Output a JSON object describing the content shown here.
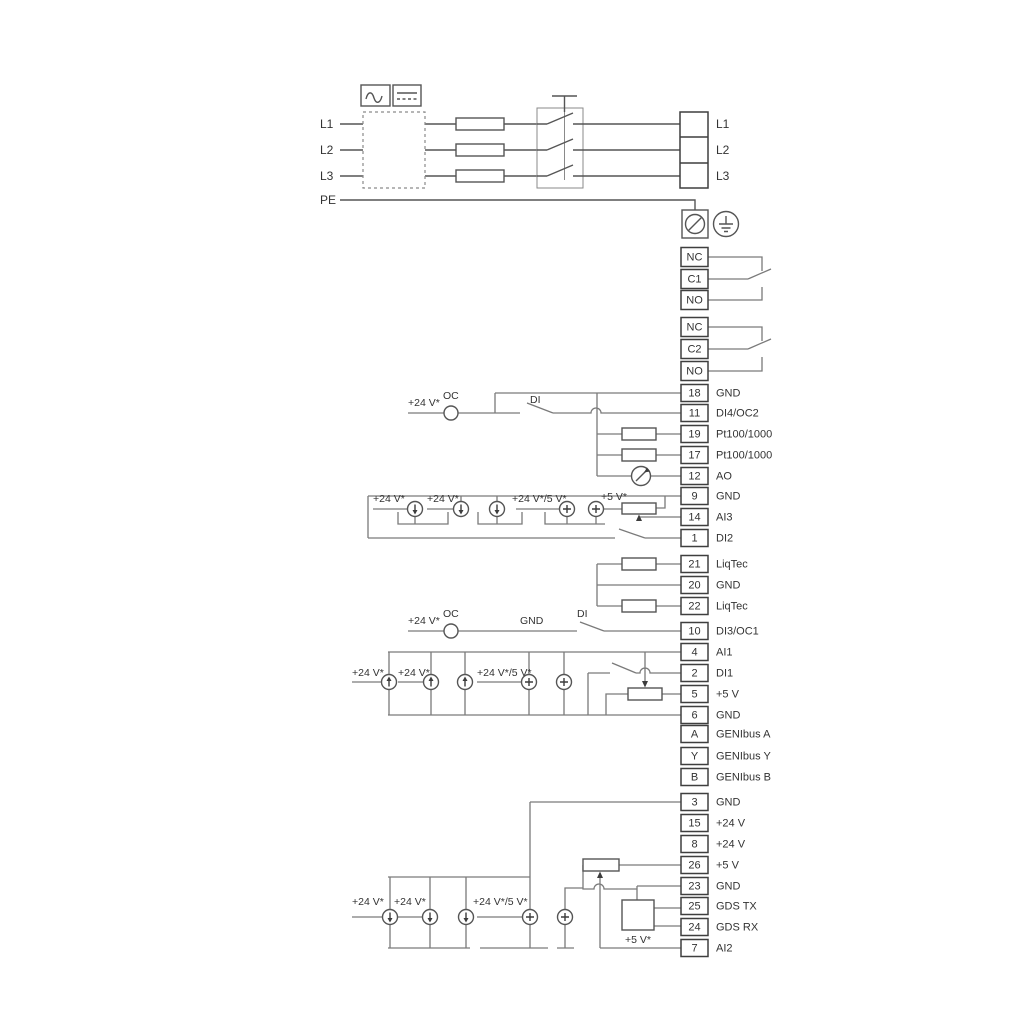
{
  "power": {
    "input_lines": [
      "L1",
      "L2",
      "L3",
      "PE"
    ],
    "output_terminals": [
      "L1",
      "L2",
      "L3"
    ]
  },
  "relays": [
    {
      "terminals": [
        "NC",
        "C1",
        "NO"
      ]
    },
    {
      "terminals": [
        "NC",
        "C2",
        "NO"
      ]
    }
  ],
  "terminal_groups": [
    {
      "name": "io-a",
      "rows": [
        {
          "num": "18",
          "label": "GND"
        },
        {
          "num": "11",
          "label": "DI4/OC2"
        },
        {
          "num": "19",
          "label": "Pt100/1000"
        },
        {
          "num": "17",
          "label": "Pt100/1000"
        },
        {
          "num": "12",
          "label": "AO"
        },
        {
          "num": "9",
          "label": "GND"
        },
        {
          "num": "14",
          "label": "AI3"
        },
        {
          "num": "1",
          "label": "DI2"
        }
      ]
    },
    {
      "name": "liqtec",
      "rows": [
        {
          "num": "21",
          "label": "LiqTec"
        },
        {
          "num": "20",
          "label": "GND"
        },
        {
          "num": "22",
          "label": "LiqTec"
        }
      ]
    },
    {
      "name": "io-b",
      "rows": [
        {
          "num": "10",
          "label": "DI3/OC1"
        },
        {
          "num": "4",
          "label": "AI1"
        },
        {
          "num": "2",
          "label": "DI1"
        },
        {
          "num": "5",
          "label": "+5 V"
        },
        {
          "num": "6",
          "label": "GND"
        }
      ]
    },
    {
      "name": "genibus",
      "rows": [
        {
          "num": "A",
          "label": "GENIbus A"
        },
        {
          "num": "Y",
          "label": "GENIbus Y"
        },
        {
          "num": "B",
          "label": "GENIbus B"
        }
      ]
    },
    {
      "name": "io-c",
      "rows": [
        {
          "num": "3",
          "label": "GND"
        },
        {
          "num": "15",
          "label": "+24 V"
        },
        {
          "num": "8",
          "label": "+24 V"
        },
        {
          "num": "26",
          "label": "+5 V"
        },
        {
          "num": "23",
          "label": "GND"
        },
        {
          "num": "25",
          "label": "GDS TX"
        },
        {
          "num": "24",
          "label": "GDS RX"
        },
        {
          "num": "7",
          "label": "AI2"
        }
      ]
    }
  ],
  "wire_labels": {
    "v24": "+24 V*",
    "v24v5": "+24 V*/5 V*",
    "v5": "+5 V*",
    "oc": "OC",
    "di": "DI",
    "gnd": "GND"
  },
  "colors": {
    "background": "#ffffff",
    "wire": "#7a7a7a",
    "component": "#555555",
    "text": "#333333"
  }
}
